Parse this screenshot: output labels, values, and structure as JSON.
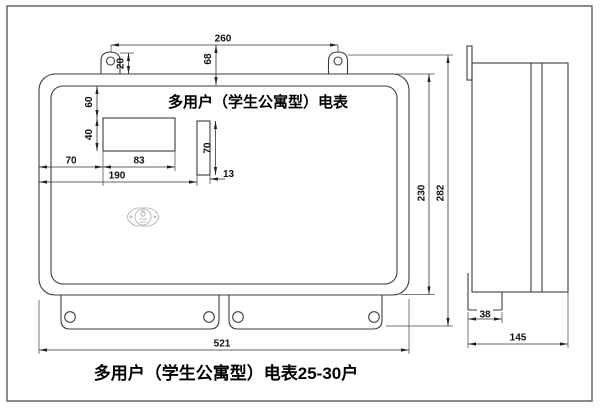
{
  "drawing": {
    "front_title": "多用户（学生公寓型）电表",
    "caption": "多用户（学生公寓型）电表25-30户",
    "dims": {
      "mount_hole_span": "260",
      "ear_height": "20",
      "top_to_panel": "68",
      "panel_to_window": "60",
      "window_height": "40",
      "left_to_window": "70",
      "window_width": "83",
      "left_to_slot": "190",
      "slot_height": "70",
      "slot_width": "13",
      "body_height": "230",
      "total_height": "282",
      "body_width": "521",
      "step_depth": "38",
      "total_depth": "145"
    },
    "colors": {
      "line": "#3c3c3c",
      "dim": "#333333",
      "text": "#000000",
      "background": "#ffffff"
    }
  }
}
